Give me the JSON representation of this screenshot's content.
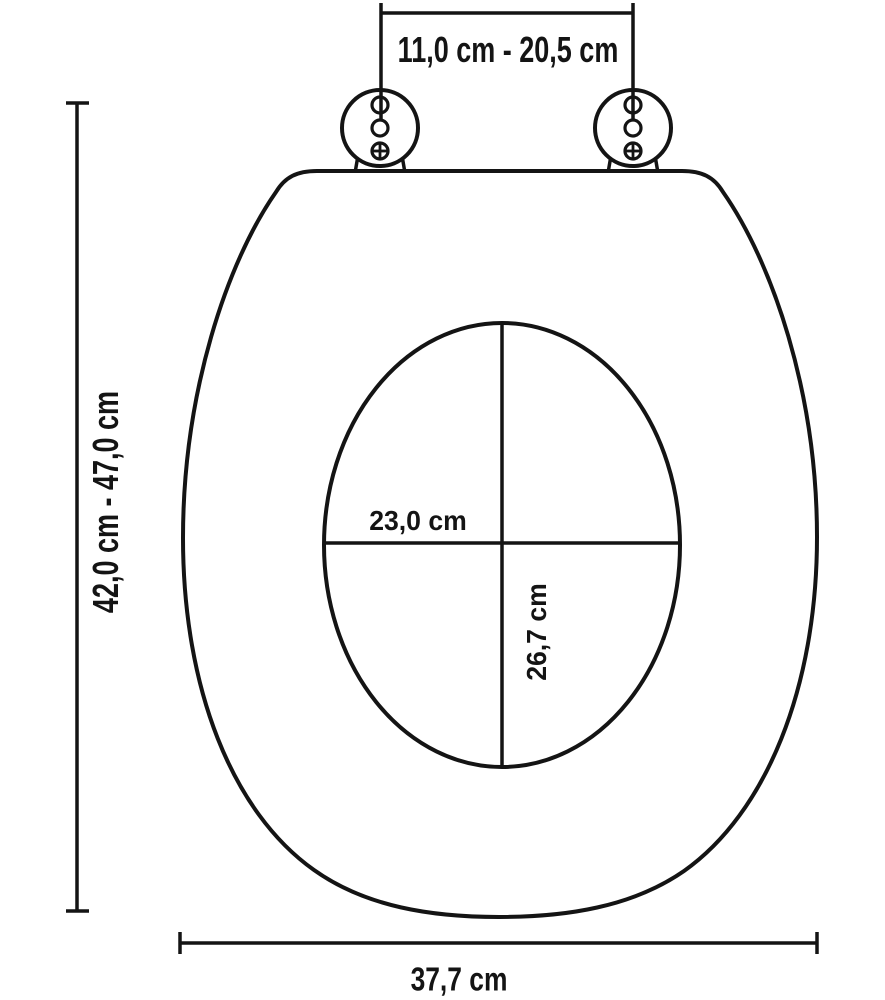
{
  "diagram": {
    "labels": {
      "hinge_spacing": "11,0 cm - 20,5 cm",
      "length_range": "42,0 cm - 47,0 cm",
      "opening_width": "23,0 cm",
      "opening_length": "26,7 cm",
      "seat_width": "37,7 cm"
    },
    "colors": {
      "line": "#141414",
      "background": "#ffffff"
    }
  }
}
